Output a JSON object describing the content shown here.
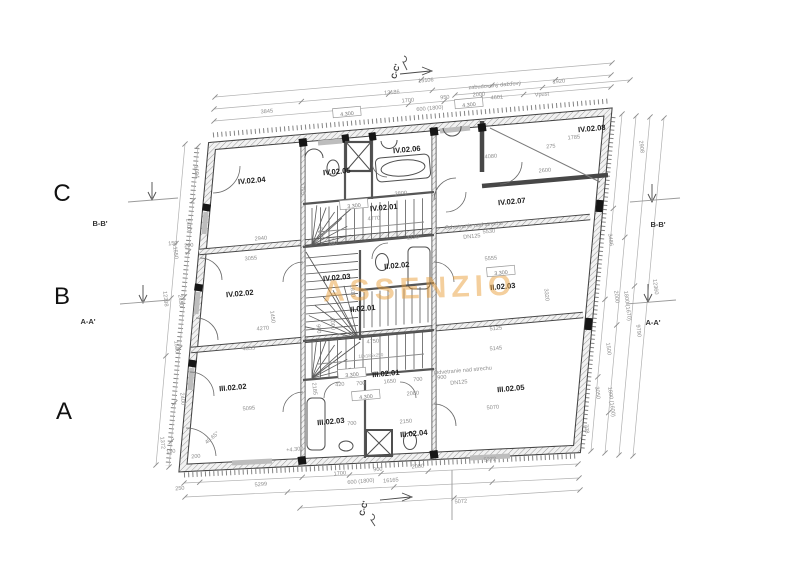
{
  "drawing": {
    "watermark": "ASSENZIO",
    "grid_rows": [
      {
        "label": "C",
        "x": 62,
        "y": 201
      },
      {
        "label": "B",
        "x": 62,
        "y": 304
      },
      {
        "label": "A",
        "x": 64,
        "y": 419
      }
    ],
    "section_labels": [
      {
        "label": "B-B'",
        "x": 100,
        "y": 226,
        "a": 0
      },
      {
        "label": "A-A'",
        "x": 88,
        "y": 324,
        "a": 0
      },
      {
        "label": "B-B'",
        "x": 658,
        "y": 227,
        "a": 0
      },
      {
        "label": "A-A'",
        "x": 653,
        "y": 325,
        "a": 0
      },
      {
        "label": "C-C'",
        "x": 398,
        "y": 72,
        "a": -75
      },
      {
        "label": "C-C'",
        "x": 366,
        "y": 509,
        "a": -75
      }
    ],
    "rooms": [
      {
        "label": "IV.02.04",
        "x": 252,
        "y": 183
      },
      {
        "label": "IV.02.05",
        "x": 337,
        "y": 174
      },
      {
        "label": "IV.02.06",
        "x": 407,
        "y": 152
      },
      {
        "label": "IV.02.01",
        "x": 384,
        "y": 210
      },
      {
        "label": "IV.02.07",
        "x": 512,
        "y": 204
      },
      {
        "label": "IV.02.08",
        "x": 592,
        "y": 131
      },
      {
        "label": "IV.02.02",
        "x": 240,
        "y": 296
      },
      {
        "label": "IV.02.03",
        "x": 337,
        "y": 280
      },
      {
        "label": "II.02.02",
        "x": 397,
        "y": 268
      },
      {
        "label": "II.02.01",
        "x": 363,
        "y": 311
      },
      {
        "label": "II.02.03",
        "x": 503,
        "y": 289
      },
      {
        "label": "III.02.02",
        "x": 233,
        "y": 390
      },
      {
        "label": "III.02.01",
        "x": 386,
        "y": 376
      },
      {
        "label": "III.02.03",
        "x": 331,
        "y": 424
      },
      {
        "label": "III.02.04",
        "x": 414,
        "y": 436
      },
      {
        "label": "III.02.05",
        "x": 511,
        "y": 391
      }
    ],
    "level_marks": [
      {
        "text": "4.300",
        "x": 347,
        "y": 114
      },
      {
        "text": "4.300",
        "x": 469,
        "y": 105
      },
      {
        "text": "3.300",
        "x": 354,
        "y": 206
      },
      {
        "text": "3.300",
        "x": 501,
        "y": 273
      },
      {
        "text": "3.300",
        "x": 352,
        "y": 375
      },
      {
        "text": "4.300",
        "x": 366,
        "y": 397
      }
    ],
    "annotations": [
      {
        "text": "zabudovaný dažďový",
        "x": 495,
        "y": 87,
        "a": -5
      },
      {
        "text": "Vpust",
        "x": 542,
        "y": 96,
        "a": -5
      },
      {
        "text": "Odvetranie nad strechu",
        "x": 474,
        "y": 227,
        "a": -5
      },
      {
        "text": "DN125",
        "x": 472,
        "y": 238,
        "a": -5
      },
      {
        "text": "Odvetranie nad strechu",
        "x": 463,
        "y": 372,
        "a": -5
      },
      {
        "text": "DN125",
        "x": 459,
        "y": 384,
        "a": -5
      },
      {
        "text": "+4.300",
        "x": 295,
        "y": 451,
        "a": -5
      },
      {
        "text": "18x185x250",
        "x": 371,
        "y": 357,
        "a": -4,
        "k": "tiny"
      }
    ],
    "dimensions": [
      {
        "t": "13186",
        "x": 392,
        "y": 94,
        "a": -5
      },
      {
        "t": "15106",
        "x": 426,
        "y": 82,
        "a": -5
      },
      {
        "t": "3845",
        "x": 267,
        "y": 113,
        "a": -5
      },
      {
        "t": "1700",
        "x": 408,
        "y": 102,
        "a": -5
      },
      {
        "t": "950",
        "x": 445,
        "y": 99,
        "a": -5
      },
      {
        "t": "2000",
        "x": 479,
        "y": 96,
        "a": -5
      },
      {
        "t": "600 (1800)",
        "x": 430,
        "y": 110,
        "a": -5
      },
      {
        "t": "4601",
        "x": 497,
        "y": 99,
        "a": -5
      },
      {
        "t": "1920",
        "x": 559,
        "y": 83,
        "a": -5
      },
      {
        "t": "2908",
        "x": 640,
        "y": 147,
        "a": 83
      },
      {
        "t": "3486",
        "x": 609,
        "y": 240,
        "a": 83
      },
      {
        "t": "12360",
        "x": 654,
        "y": 287,
        "a": 83
      },
      {
        "t": "2000",
        "x": 615,
        "y": 297,
        "a": 83
      },
      {
        "t": "1800 (1670)",
        "x": 626,
        "y": 306,
        "a": 83
      },
      {
        "t": "9790",
        "x": 637,
        "y": 331,
        "a": 83
      },
      {
        "t": "1500",
        "x": 607,
        "y": 349,
        "a": 83
      },
      {
        "t": "3050",
        "x": 596,
        "y": 393,
        "a": 83
      },
      {
        "t": "1800 (1600)",
        "x": 610,
        "y": 402,
        "a": 83
      },
      {
        "t": "738",
        "x": 585,
        "y": 429,
        "a": 83
      },
      {
        "t": "250",
        "x": 180,
        "y": 490,
        "a": -5
      },
      {
        "t": "5299",
        "x": 261,
        "y": 486,
        "a": -5
      },
      {
        "t": "1700",
        "x": 340,
        "y": 475,
        "a": -5
      },
      {
        "t": "900",
        "x": 378,
        "y": 471,
        "a": -5
      },
      {
        "t": "2000",
        "x": 418,
        "y": 468,
        "a": -5
      },
      {
        "t": "600 (1800)",
        "x": 361,
        "y": 483,
        "a": -5
      },
      {
        "t": "16165",
        "x": 391,
        "y": 482,
        "a": -5
      },
      {
        "t": "5272",
        "x": 490,
        "y": 461,
        "a": -5
      },
      {
        "t": "5072",
        "x": 461,
        "y": 503,
        "a": -5
      },
      {
        "t": "1004",
        "x": 195,
        "y": 172,
        "a": 84
      },
      {
        "t": "2400",
        "x": 187,
        "y": 225,
        "a": 84
      },
      {
        "t": "1550",
        "x": 174,
        "y": 253,
        "a": 84
      },
      {
        "t": "12398",
        "x": 164,
        "y": 299,
        "a": 84
      },
      {
        "t": "2450",
        "x": 179,
        "y": 301,
        "a": 84
      },
      {
        "t": "1500",
        "x": 175,
        "y": 347,
        "a": 84
      },
      {
        "t": "2400",
        "x": 181,
        "y": 399,
        "a": 84
      },
      {
        "t": "1372",
        "x": 161,
        "y": 443,
        "a": 84
      },
      {
        "t": "150",
        "x": 173,
        "y": 245,
        "a": -5
      },
      {
        "t": "200",
        "x": 189,
        "y": 247,
        "a": -5
      },
      {
        "t": "150",
        "x": 171,
        "y": 453,
        "a": -5
      },
      {
        "t": "200",
        "x": 196,
        "y": 458,
        "a": -5
      },
      {
        "t": "2940",
        "x": 261,
        "y": 240,
        "a": -5
      },
      {
        "t": "1725",
        "x": 301,
        "y": 189,
        "a": 84
      },
      {
        "t": "2300",
        "x": 319,
        "y": 233,
        "a": 84
      },
      {
        "t": "1130",
        "x": 413,
        "y": 239,
        "a": -5
      },
      {
        "t": "100",
        "x": 333,
        "y": 245,
        "a": -5
      },
      {
        "t": "3800",
        "x": 401,
        "y": 195,
        "a": -5
      },
      {
        "t": "4770",
        "x": 374,
        "y": 220,
        "a": -5
      },
      {
        "t": "4080",
        "x": 491,
        "y": 158,
        "a": -5
      },
      {
        "t": "5530",
        "x": 489,
        "y": 233,
        "a": -5
      },
      {
        "t": "2600",
        "x": 545,
        "y": 172,
        "a": -5
      },
      {
        "t": "1785",
        "x": 574,
        "y": 139,
        "a": -5
      },
      {
        "t": "275",
        "x": 551,
        "y": 148,
        "a": -5
      },
      {
        "t": "3055",
        "x": 251,
        "y": 260,
        "a": -5
      },
      {
        "t": "1450",
        "x": 271,
        "y": 317,
        "a": 84
      },
      {
        "t": "1810",
        "x": 351,
        "y": 291,
        "a": 84
      },
      {
        "t": "4270",
        "x": 263,
        "y": 330,
        "a": -5
      },
      {
        "t": "5555",
        "x": 491,
        "y": 260,
        "a": -5
      },
      {
        "t": "3320",
        "x": 545,
        "y": 295,
        "a": 84
      },
      {
        "t": "5125",
        "x": 496,
        "y": 330,
        "a": -5
      },
      {
        "t": "4355",
        "x": 249,
        "y": 350,
        "a": -5
      },
      {
        "t": "900",
        "x": 317,
        "y": 329,
        "a": 84
      },
      {
        "t": "2000",
        "x": 331,
        "y": 324,
        "a": 84
      },
      {
        "t": "5095",
        "x": 249,
        "y": 410,
        "a": -5
      },
      {
        "t": "2185",
        "x": 313,
        "y": 389,
        "a": 84
      },
      {
        "t": "4750",
        "x": 373,
        "y": 343,
        "a": -5
      },
      {
        "t": "420",
        "x": 340,
        "y": 386,
        "a": -5
      },
      {
        "t": "700",
        "x": 361,
        "y": 385,
        "a": -5
      },
      {
        "t": "1650",
        "x": 390,
        "y": 383,
        "a": -5
      },
      {
        "t": "700",
        "x": 418,
        "y": 381,
        "a": -5
      },
      {
        "t": "900",
        "x": 442,
        "y": 379,
        "a": -5
      },
      {
        "t": "2080",
        "x": 413,
        "y": 395,
        "a": -5
      },
      {
        "t": "5145",
        "x": 496,
        "y": 350,
        "a": -5
      },
      {
        "t": "5070",
        "x": 493,
        "y": 409,
        "a": -5
      },
      {
        "t": "700",
        "x": 352,
        "y": 425,
        "a": -5
      },
      {
        "t": "2150",
        "x": 406,
        "y": 423,
        "a": -5
      },
      {
        "t": "40.65°",
        "x": 213,
        "y": 439,
        "a": -40
      }
    ]
  }
}
